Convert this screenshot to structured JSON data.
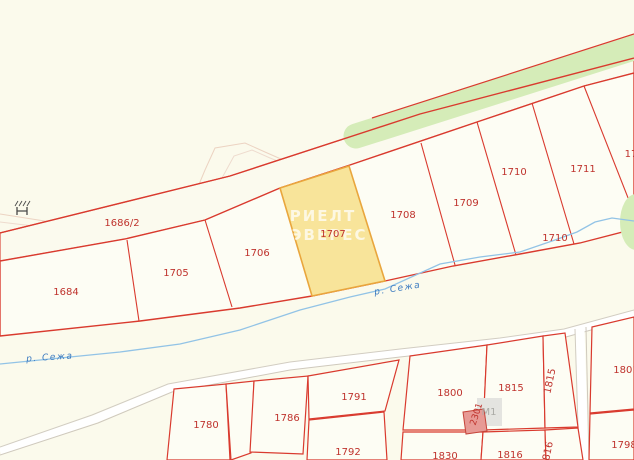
{
  "map": {
    "type": "cadastral-map",
    "parcels": {
      "upper": {
        "p1684": "1684",
        "p1686_2": "1686/2",
        "p1705": "1705",
        "p1706": "1706",
        "p1707": "1707",
        "p1708": "1708",
        "p1709": "1709",
        "p1710": "1710",
        "p1710_lower": "1710",
        "p1711": "1711",
        "p17_clipped": "17"
      },
      "bottom_left": {
        "p1780": "1780",
        "p1786": "1786",
        "p1791": "1791",
        "p1792": "1792"
      },
      "bottom_right": {
        "p1800": "1800",
        "p1815": "1815",
        "p1815_sliver": "1815",
        "p1830": "1830",
        "p1816": "1816",
        "p816_sliver": "816"
      },
      "far_right": {
        "p1801": "1801",
        "p1798": "1798"
      }
    },
    "selected_parcel": {
      "id": "1707"
    },
    "river": {
      "label": "р. Сежа"
    },
    "building": {
      "id": "2301",
      "marker": "М1"
    },
    "watermark": {
      "line1": "РИЕЛТ",
      "line2": "ЭВЕРЕС"
    },
    "colors": {
      "background": "#fbfaec",
      "block_fill": "#fdfdf4",
      "boundary_red": "#d93a2e",
      "label_red": "#bf332d",
      "selected_fill": "#f8e49a",
      "selected_border": "#e9a63d",
      "forest_green": "#d5ecb8",
      "river_blue": "#92c3e6",
      "river_label_blue": "#3c7bc0",
      "faint_road": "#ecd3c2",
      "gray_road_edge": "#d2cdc2",
      "building_fill": "#e79a95",
      "building_border": "#c5453b"
    }
  }
}
